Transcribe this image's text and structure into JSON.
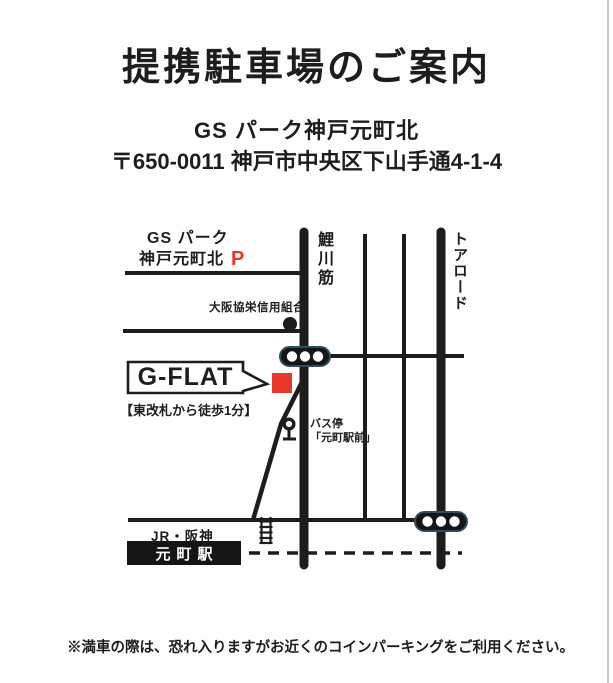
{
  "page": {
    "title": "提携駐車場のご案内",
    "parking_name": "GS パーク神戸元町北",
    "parking_address": "〒650-0011 神戸市中央区下山手通4-1-4",
    "footer_note": "※満車の際は、恐れ入りますがお近くのコインパーキングをご利用ください。"
  },
  "map": {
    "parking_label_line1": "GS パーク",
    "parking_label_line2": "神戸元町北",
    "parking_symbol": "P",
    "bank_label": "大阪協栄信用組合",
    "road_vertical_left": "鯉川筋",
    "road_vertical_right": "トアロード",
    "building_name": "G-FLAT",
    "building_note": "【東改札から徒歩1分】",
    "bus_stop_line1": "バス停",
    "bus_stop_line2": "「元町駅前」",
    "rail_label": "JR・阪神",
    "station_name": "元町駅",
    "colors": {
      "accent_red": "#e8372d",
      "road_black": "#1d1d1b",
      "signal_border": "#2f4e5c",
      "station_bg": "#151515"
    }
  }
}
